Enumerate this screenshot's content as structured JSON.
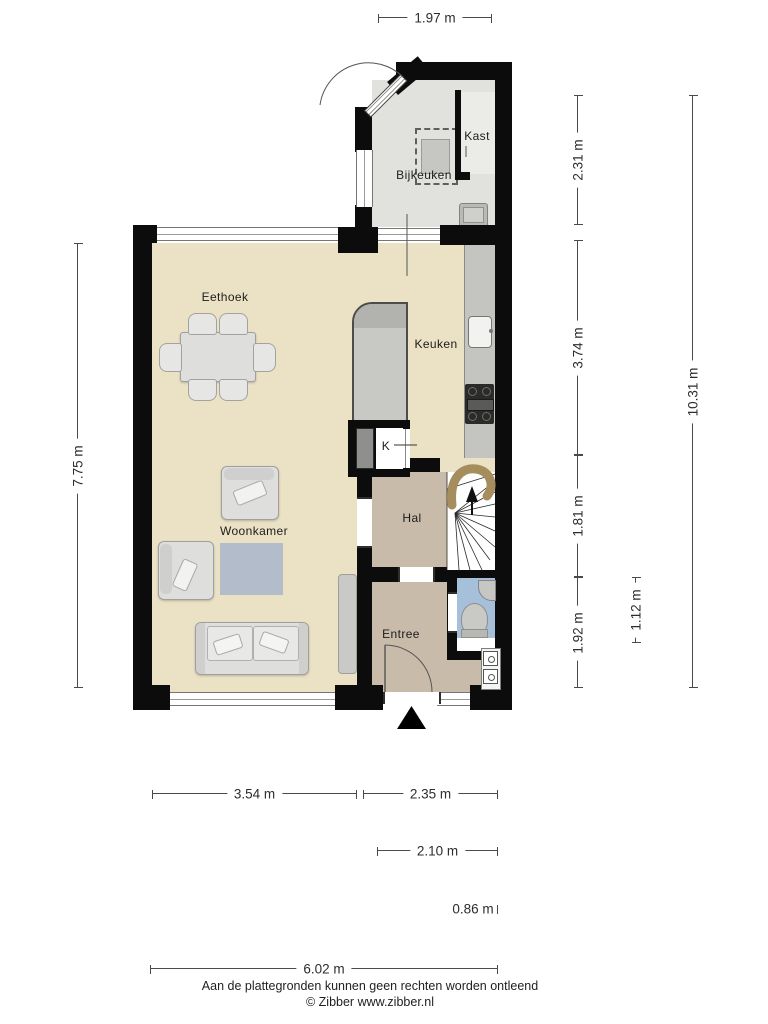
{
  "plan": {
    "rooms": {
      "eethoek": "Eethoek",
      "keuken": "Keuken",
      "woonkamer": "Woonkamer",
      "hal": "Hal",
      "entree": "Entree",
      "bijkeuken": "Bijkeuken",
      "kast": "Kast",
      "k_closet": "K"
    }
  },
  "dimensions": {
    "top_width": "1.97 m",
    "right_seg1": "2.31 m",
    "right_seg2": "3.74 m",
    "right_seg3": "1.81 m",
    "right_seg4": "1.92 m",
    "toilet_depth": "1.12 m",
    "total_height": "10.31 m",
    "left_height": "7.75 m",
    "bottom_seg1": "3.54 m",
    "bottom_seg2": "2.35 m",
    "bottom_seg3": "2.10 m",
    "bottom_seg4": "0.86 m",
    "total_width": "6.02 m"
  },
  "footer": {
    "disclaimer": "Aan de plattegronden kunnen geen rechten worden ontleend",
    "credit": "© Zibber www.zibber.nl"
  },
  "colors": {
    "wall": "#0c0c0c",
    "floor_living": "#ebe2c5",
    "floor_utility": "#e1e1de",
    "floor_hall": "#c9bbaa",
    "floor_toilet": "#a6c0d9",
    "rug": "#b2bcca",
    "stair_rail": "#a68d5e"
  }
}
